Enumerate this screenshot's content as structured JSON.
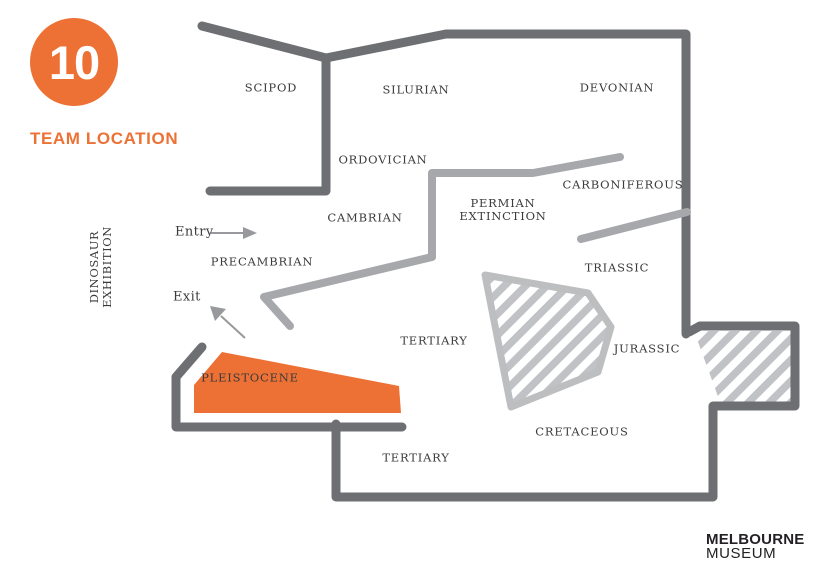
{
  "header": {
    "badge_number": "10",
    "title": "TEAM LOCATION"
  },
  "exhibition_label": {
    "line1": "DINOSAUR",
    "line2": "EXHIBITION"
  },
  "map": {
    "areas": {
      "scipod": "SCIPOD",
      "silurian": "SILURIAN",
      "devonian": "DEVONIAN",
      "ordovician": "ORDOVICIAN",
      "carboniferous": "CARBONIFEROUS",
      "cambrian": "CAMBRIAN",
      "permian_line1": "PERMIAN",
      "permian_line2": "EXTINCTION",
      "precambrian": "PRECAMBRIAN",
      "triassic": "TRIASSIC",
      "tertiary_upper": "TERTIARY",
      "jurassic": "JURASSIC",
      "pleistocene": "PLEISTOCENE",
      "cretaceous": "CRETACEOUS",
      "tertiary_lower": "TERTIARY"
    },
    "entry_label": "Entry",
    "exit_label": "Exit",
    "highlighted_area": "PLEISTOCENE"
  },
  "logo": {
    "line1": "MELBOURNE",
    "line2": "MUSEUM"
  },
  "colors": {
    "accent_orange": "#ed7134",
    "wall_dark": "#6e6f72",
    "wall_light": "#a6a8ab",
    "hatch_gray": "#c0c2c5",
    "label_text": "#3b3b3d",
    "logo_text": "#242124"
  }
}
